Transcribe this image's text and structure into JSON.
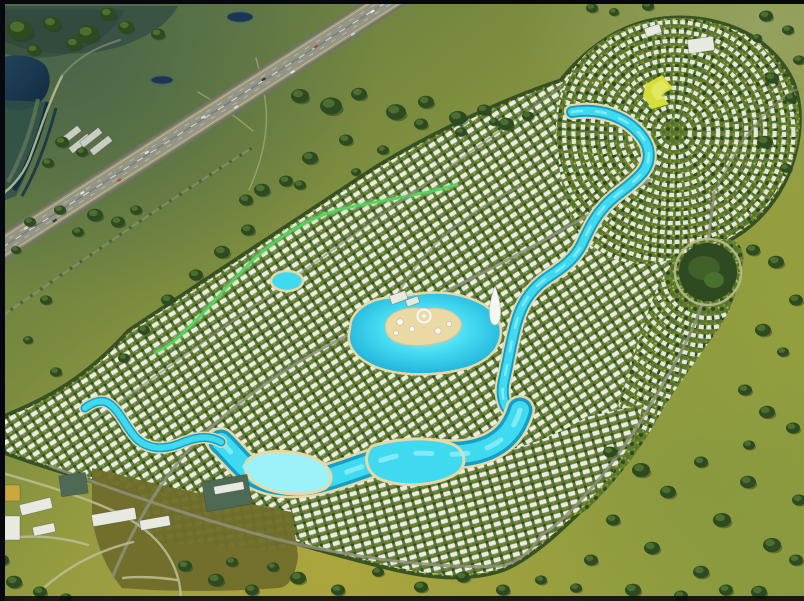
{
  "scene": {
    "width": 804,
    "height": 601,
    "label": "aerial-render-lagoon-community"
  },
  "palette": {
    "border": "#06080d",
    "marsh": "#3a5345",
    "marsh-dark": "#2b4238",
    "terrace-a": "#2f4f48",
    "terrace-b": "#123043",
    "terrace-c": "#5a7259",
    "hwy-asphalt": "#93948a",
    "hwy-dark": "#73746b",
    "road": "#8e927c",
    "road-light": "#b9bd92",
    "dirt": "#b9b98b",
    "dev-green": "#5e7c30",
    "tree-dark": "#2d4a20",
    "tree-mid": "#4e7030",
    "tree-light": "#b7c33f",
    "house": "#ebebe4",
    "lagoon-deep": "#149fc9",
    "lagoon-core": "#3fd9f0",
    "lagoon-light": "#9df2fa",
    "sand": "#e6d9a8",
    "island-sand": "#ead9a5",
    "park-yellow": "#d6de3a",
    "olive-field": "#6f6d2b",
    "roof-white": "#e8eae2",
    "roof-green2": "#4e6a55",
    "roof-gold": "#c9a93d",
    "roof-ware": "#c9cdc4"
  },
  "highway": {
    "a": [
      399,
      0
    ],
    "b": [
      -4,
      252
    ]
  },
  "paths": {
    "footprint": "M 0,420 C 45,402 85,382 130,332 L 375,170 C 430,136 502,102 562,82 C 584,54 614,31 648,23 C 690,14 736,23 766,49 C 791,71 801,96 797,133 C 793,168 777,202 746,227 C 716,249 689,257 671,290 C 655,322 651,362 644,402 C 635,442 615,474 587,502 C 559,530 531,556 503,568 C 468,580 428,576 388,566 C 336,553 288,540 238,522 C 188,505 138,492 92,479 C 58,469 26,459 0,449 Z",
    "marsh": "M 0,6 L 178,6 C 170,22 150,36 122,46 C 90,56 50,56 22,48 L 0,40 Z",
    "lake": "M 0,58 C 16,53 34,55 44,64 C 52,73 51,88 44,98 C 35,109 18,113 6,108 L 0,105 Z",
    "terrBand": "M 0,100 L 50,102 C 42,136 30,168 16,196 L 0,202 Z",
    "terr1": "M 48,102 C 41,132 30,162 14,190",
    "terr2": "M 38,99 C 32,128 22,156 8,182",
    "terr3": "M 56,108 C 48,138 38,168 22,196",
    "hwy": "M 399,-6 L -8,254",
    "hwyY1": "M 394.8,-12.8 L -12.2,247.2",
    "hwyY2": "M 403.2,0.8 L -3.8,260.8",
    "hwyL1": "M 396.9,-9.4 L -10.1,250.6",
    "hwyL2": "M 401.1,-2.6 L -5.9,257.4",
    "frontage": "M 252,148 C 175,196 95,252 -4,320",
    "slip": "M 62,76 C 49,102 41,128 32,152 C 26,171 14,187 -2,197",
    "slip2": "M 62,76 C 76,58 96,47 120,40",
    "trail1": "M 256,58 C 263,84 268,106 266,128 C 264,152 257,172 249,190",
    "trail2": "M 198,92 C 222,106 240,120 253,131",
    "blobB": "M 556,122 C 556,92 574,60 600,42 C 626,23 661,15 696,19 C 731,23 763,42 783,70 C 799,93 803,119 797,146 C 791,176 772,203 744,225 C 716,247 685,257 661,262 C 629,268 599,258 581,235 C 563,213 556,152 556,122 Z",
    "bandC": "M 560,502 C 586,472 606,442 618,406 C 630,370 641,330 653,298 C 665,268 681,250 701,242 C 726,232 747,241 743,263 C 739,287 731,311 717,331 C 696,361 673,391 656,421 C 639,452 616,481 591,506 C 576,521 560,517 560,502 Z",
    "zoneD": "M 298,482 C 358,472 430,464 490,454 C 530,447 562,432 587,417 L 643,404 C 634,444 614,476 586,503 C 558,531 530,556 502,568 C 467,579 428,575 388,565 C 348,555 308,544 283,534 C 288,516 293,499 298,482 Z",
    "zoneF": "M 138,490 L 292,510 L 287,550 L 148,542 Z",
    "oliveField": "M 92,468 C 160,486 230,500 292,512 L 298,556 C 296,576 288,588 278,588 C 228,592 170,592 122,588 C 104,566 95,540 92,516 Z",
    "corridor": "M 458,184 C 420,196 382,200 346,208 C 310,216 280,236 255,258 C 230,282 206,312 181,335 C 170,345 161,350 154,353",
    "roadMain": "M 112,578 C 136,520 166,470 206,432 C 256,385 320,345 386,318 C 452,291 520,254 576,222 C 608,204 632,190 650,180",
    "roadBranch": "M 386,318 C 398,290 416,262 442,238 C 466,216 494,198 522,186",
    "roadNE1": "M 714,192 C 712,212 710,228 708,240",
    "roadNE2": "M 702,304 C 690,340 670,372 651,404 C 630,440 607,472 579,502 C 562,521 550,530 541,535",
    "roadNE3": "M 716,190 C 730,158 749,129 771,108 C 783,96 793,90 802,88",
    "roadBoundNW": "M 94,420 L 560,88",
    "roadBottom": "M 50,466 C 120,492 200,520 280,540 C 350,557 432,569 500,566 C 517,563 531,552 541,535",
    "roadOff1": "M -2,472 C 50,486 90,500 116,512 C 152,530 172,552 179,582 C 181,592 181,597 180,601",
    "roadOff2": "M 177,580 C 152,576 130,577 123,578",
    "roadOff3": "M 30,601 C 58,572 92,552 133,542",
    "roadOff4": "M -2,540 C 28,534 58,536 88,545",
    "riverA": "M 572,112 C 601,107 626,118 639,133 C 651,146 652,161 642,173 C 630,187 615,194 604,207 C 594,218 588,231 582,244 C 573,262 558,270 544,280 C 529,292 521,305 516,324 C 511,343 508,362 504,380 C 500,398 505,410 517,417",
    "lagoonB": "M 520,410 C 512,437 493,449 469,453 C 444,457 424,450 401,455 C 377,460 352,471 328,478 C 304,485 277,486 257,476 C 243,468 233,453 221,442",
    "streamC": "M 221,442 C 207,434 193,438 179,444 C 163,450 148,449 137,439 C 127,429 121,413 111,405 C 103,398 93,402 85,408",
    "beachPool": "M 250,458 C 268,448 298,450 318,460 C 332,468 336,482 324,489 C 302,498 270,494 254,482 C 244,474 242,464 250,458 Z",
    "bulge": "M 372,446 C 398,438 430,436 452,444 C 466,450 468,466 456,474 C 436,486 404,488 382,480 C 366,474 362,456 372,446 Z",
    "centralLagoon": "M 352,322 C 358,306 378,297 398,299 C 418,293 446,291 468,299 C 490,306 503,320 499,338 C 495,355 478,365 458,369 C 436,374 408,375 386,369 C 366,364 349,351 350,336 Z",
    "island": "M 388,318 C 396,309 412,306 426,309 C 442,306 457,312 461,322 C 463,332 452,340 438,343 C 422,347 404,346 394,341 C 385,336 383,326 388,318 Z",
    "tower": "M 495,286 C 499,297 502,309 500,319 C 498,327 492,327 490,319 C 488,309 491,297 495,286 Z",
    "parkYellow": "M 646,84 L 662,75 L 673,88 L 661,95 L 669,104 L 652,109 L 643,96 Z",
    "bufTrees1": "M 70,432 L 546,100",
    "bufTrees2": "M 56,448 L 532,116"
  },
  "arc_zones": [
    {
      "clip": "blobB",
      "cx": 674,
      "cy": 132,
      "r0": 16,
      "r1": 152,
      "step": 9.4
    },
    {
      "clip": "bandC",
      "cx": 708,
      "cy": 272,
      "r0": 46,
      "r1": 175,
      "step": 9.4
    }
  ],
  "roundabout": {
    "cx": 708,
    "cy": 272,
    "ring": 33,
    "park": 29
  },
  "vehicles": [
    [
      0.06,
      4.5,
      "#e8e8e8"
    ],
    [
      0.12,
      -4.5,
      "#caced2"
    ],
    [
      0.2,
      4.5,
      "#b2402f"
    ],
    [
      0.27,
      -4.5,
      "#e5e5e5"
    ],
    [
      0.33,
      4.5,
      "#2e3338"
    ],
    [
      0.41,
      -4.5,
      "#e0ddd6"
    ],
    [
      0.48,
      4.5,
      "#d9d9d9"
    ],
    [
      0.55,
      -4.5,
      "#97a0a8"
    ],
    [
      0.62,
      4.5,
      "#e8e4da"
    ],
    [
      0.7,
      -4.5,
      "#c7442e"
    ],
    [
      0.78,
      4.5,
      "#e2e2e2"
    ],
    [
      0.86,
      -4.5,
      "#33383d"
    ],
    [
      0.92,
      4.5,
      "#dddad2"
    ]
  ],
  "buildings": [
    [
      688,
      38,
      26,
      14,
      -8,
      "roof-white"
    ],
    [
      645,
      26,
      16,
      9,
      -18,
      "roof-white"
    ],
    [
      390,
      293,
      17,
      9,
      -20,
      "roof-white"
    ],
    [
      406,
      298,
      13,
      7,
      -20,
      "roof-white"
    ],
    [
      58,
      132,
      24,
      7,
      -38,
      "roof-ware"
    ],
    [
      68,
      140,
      24,
      7,
      -38,
      "roof-ware"
    ],
    [
      79,
      134,
      24,
      7,
      -38,
      "roof-ware"
    ],
    [
      89,
      142,
      24,
      7,
      -38,
      "roof-ware"
    ],
    [
      60,
      474,
      27,
      21,
      -8,
      "roof-green2"
    ],
    [
      204,
      478,
      46,
      30,
      -10,
      "roof-green2"
    ],
    [
      214,
      484,
      30,
      8,
      -10,
      "roof-white"
    ],
    [
      20,
      501,
      32,
      11,
      -14,
      "roof-white"
    ],
    [
      92,
      511,
      44,
      12,
      -10,
      "roof-white"
    ],
    [
      5,
      485,
      15,
      16,
      0,
      "roof-gold"
    ],
    [
      0,
      516,
      20,
      24,
      0,
      "roof-white"
    ],
    [
      33,
      525,
      22,
      9,
      -12,
      "roof-white"
    ],
    [
      140,
      518,
      30,
      10,
      -10,
      "roof-white"
    ]
  ],
  "island_circles": [
    [
      400,
      322,
      3.4
    ],
    [
      412,
      329,
      2.8
    ],
    [
      438,
      331,
      3.2
    ],
    [
      449,
      324,
      2.6
    ],
    [
      396,
      333,
      2.4
    ]
  ],
  "ponds": [
    [
      240,
      17,
      13,
      5
    ],
    [
      162,
      80,
      11,
      4
    ]
  ],
  "trees": [
    [
      20,
      30,
      13
    ],
    [
      52,
      24,
      9
    ],
    [
      88,
      34,
      11
    ],
    [
      126,
      27,
      8
    ],
    [
      158,
      34,
      7
    ],
    [
      108,
      14,
      8
    ],
    [
      74,
      44,
      8
    ],
    [
      34,
      50,
      7
    ],
    [
      300,
      96,
      9
    ],
    [
      331,
      106,
      11
    ],
    [
      359,
      94,
      8
    ],
    [
      396,
      112,
      10
    ],
    [
      426,
      102,
      8
    ],
    [
      458,
      118,
      9
    ],
    [
      484,
      110,
      7
    ],
    [
      506,
      124,
      8
    ],
    [
      528,
      116,
      6
    ],
    [
      262,
      190,
      8
    ],
    [
      286,
      181,
      7
    ],
    [
      246,
      200,
      7
    ],
    [
      222,
      252,
      8
    ],
    [
      248,
      230,
      7
    ],
    [
      196,
      275,
      7
    ],
    [
      168,
      300,
      7
    ],
    [
      144,
      330,
      6
    ],
    [
      124,
      358,
      6
    ],
    [
      62,
      142,
      7
    ],
    [
      82,
      152,
      6
    ],
    [
      48,
      163,
      6
    ],
    [
      30,
      222,
      6
    ],
    [
      16,
      250,
      5
    ],
    [
      46,
      300,
      6
    ],
    [
      28,
      340,
      5
    ],
    [
      56,
      372,
      6
    ],
    [
      95,
      215,
      8
    ],
    [
      118,
      222,
      7
    ],
    [
      78,
      232,
      6
    ],
    [
      60,
      210,
      6
    ],
    [
      136,
      210,
      6
    ],
    [
      592,
      8,
      6
    ],
    [
      614,
      12,
      5
    ],
    [
      648,
      6,
      6
    ],
    [
      766,
      16,
      7
    ],
    [
      788,
      30,
      6
    ],
    [
      757,
      38,
      5
    ],
    [
      799,
      60,
      6
    ],
    [
      772,
      78,
      7
    ],
    [
      791,
      98,
      6
    ],
    [
      765,
      142,
      8
    ],
    [
      786,
      168,
      6
    ],
    [
      753,
      250,
      7
    ],
    [
      776,
      262,
      8
    ],
    [
      796,
      300,
      7
    ],
    [
      763,
      330,
      8
    ],
    [
      783,
      352,
      6
    ],
    [
      745,
      390,
      7
    ],
    [
      767,
      412,
      8
    ],
    [
      793,
      428,
      7
    ],
    [
      749,
      445,
      6
    ],
    [
      610,
      452,
      7
    ],
    [
      641,
      470,
      9
    ],
    [
      668,
      492,
      8
    ],
    [
      701,
      462,
      7
    ],
    [
      722,
      520,
      9
    ],
    [
      748,
      482,
      8
    ],
    [
      772,
      545,
      9
    ],
    [
      701,
      572,
      8
    ],
    [
      652,
      548,
      8
    ],
    [
      613,
      520,
      7
    ],
    [
      591,
      560,
      7
    ],
    [
      633,
      590,
      8
    ],
    [
      681,
      596,
      7
    ],
    [
      759,
      592,
      8
    ],
    [
      799,
      500,
      7
    ],
    [
      726,
      590,
      7
    ],
    [
      576,
      588,
      6
    ],
    [
      796,
      560,
      7
    ],
    [
      185,
      566,
      7
    ],
    [
      216,
      580,
      8
    ],
    [
      252,
      590,
      7
    ],
    [
      298,
      578,
      8
    ],
    [
      338,
      590,
      7
    ],
    [
      378,
      572,
      6
    ],
    [
      421,
      587,
      7
    ],
    [
      463,
      577,
      7
    ],
    [
      503,
      590,
      7
    ],
    [
      232,
      562,
      6
    ],
    [
      273,
      567,
      6
    ],
    [
      541,
      580,
      6
    ],
    [
      14,
      582,
      8
    ],
    [
      40,
      592,
      7
    ],
    [
      2,
      560,
      7
    ],
    [
      66,
      598,
      6
    ],
    [
      310,
      158,
      8
    ],
    [
      346,
      140,
      7
    ],
    [
      383,
      150,
      6
    ],
    [
      421,
      124,
      7
    ],
    [
      461,
      132,
      6
    ],
    [
      494,
      122,
      5
    ],
    [
      356,
      172,
      5
    ],
    [
      300,
      185,
      6
    ]
  ],
  "roads": [
    {
      "d": "roadMain",
      "cls": "road"
    },
    {
      "d": "roadBranch",
      "cls": "road-thin"
    },
    {
      "d": "roadNE1",
      "cls": "road"
    },
    {
      "d": "roadNE2",
      "cls": "road"
    },
    {
      "d": "roadNE3",
      "cls": "road-thin"
    },
    {
      "d": "roadBoundNW",
      "cls": "road-thin"
    },
    {
      "d": "roadBottom",
      "cls": "road"
    },
    {
      "d": "roadOff1",
      "cls": "road-light"
    },
    {
      "d": "roadOff2",
      "cls": "road-light"
    },
    {
      "d": "roadOff3",
      "cls": "road-light"
    },
    {
      "d": "roadOff4",
      "cls": "road-light"
    }
  ]
}
